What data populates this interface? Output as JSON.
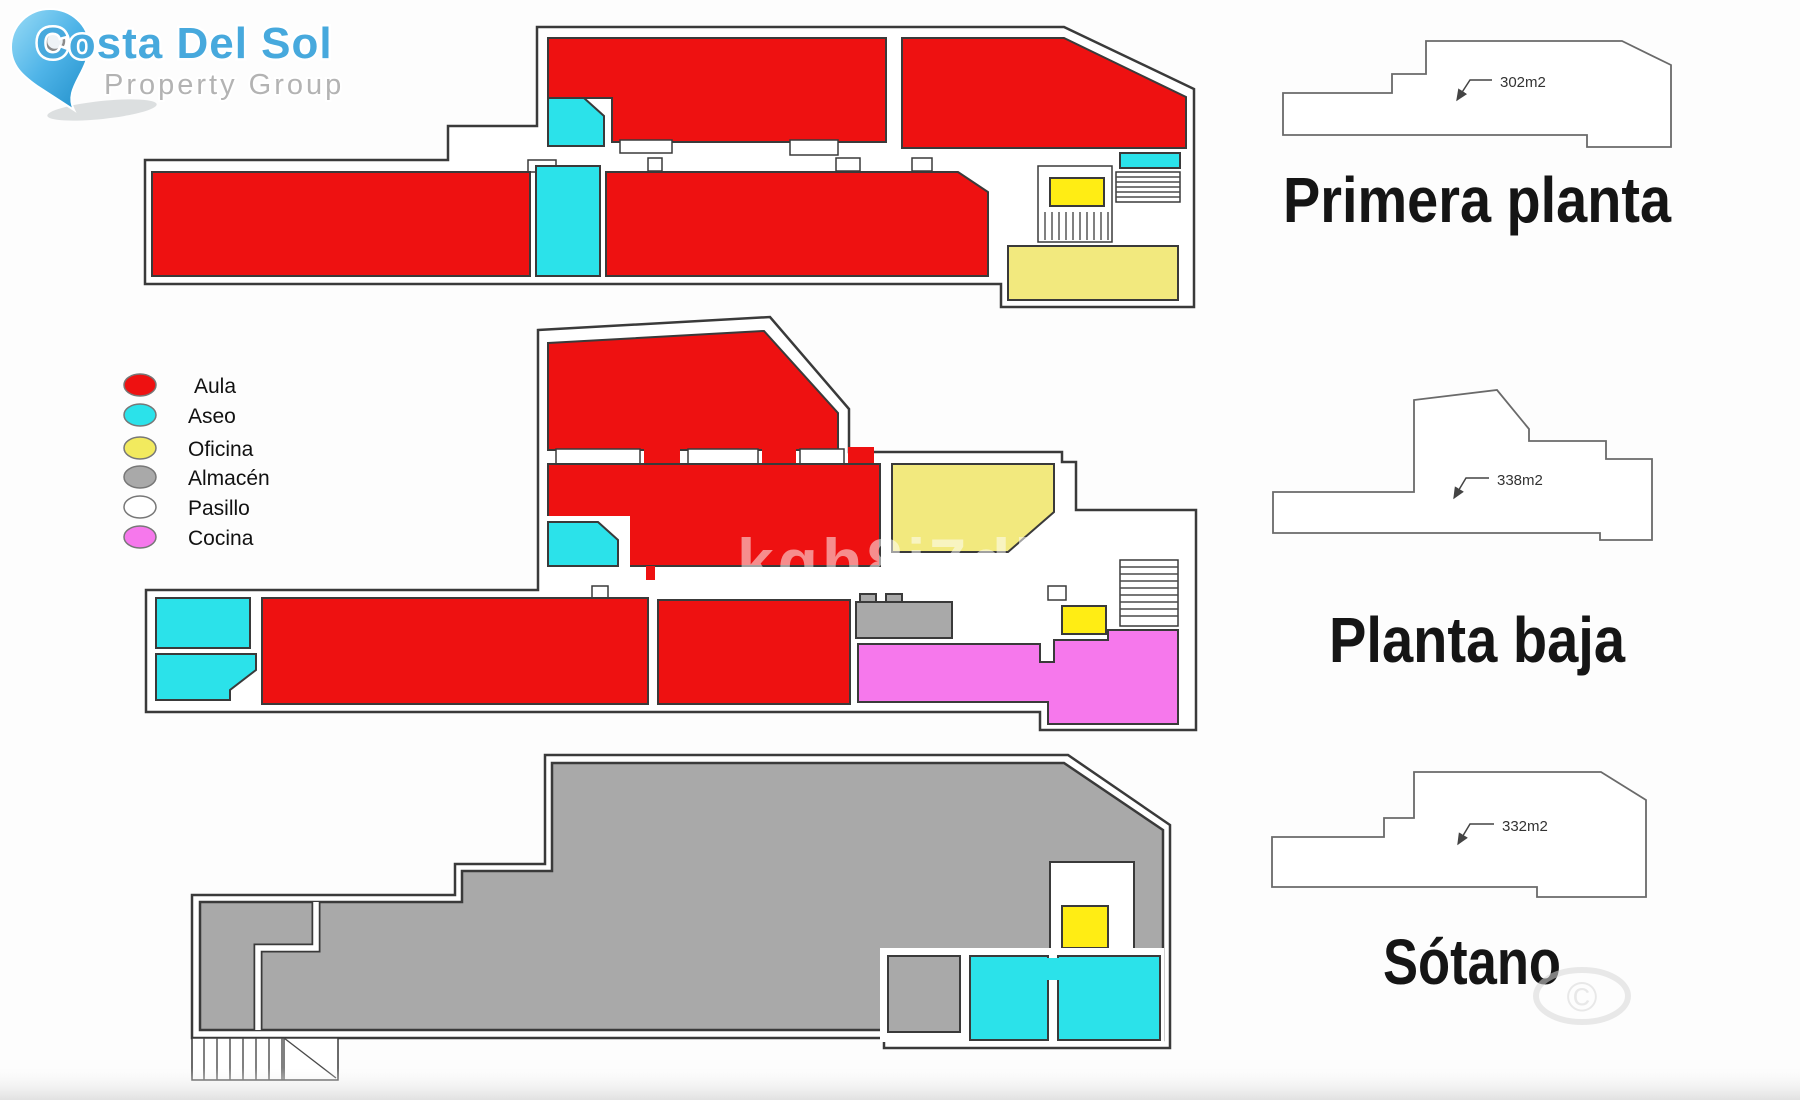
{
  "logo": {
    "title": "Costa Del Sol",
    "subtitle": "Property Group",
    "pin_icon": "map-pin-icon",
    "title_color": "#47A9DD",
    "subtitle_color": "#B3B3B3"
  },
  "legend": {
    "items": [
      {
        "label": "Aula",
        "color": "#EE1111"
      },
      {
        "label": "Aseo",
        "color": "#2BE2EA"
      },
      {
        "label": "Oficina",
        "color": "#F2EA5E"
      },
      {
        "label": "Almacén",
        "color": "#A9A9A9"
      },
      {
        "label": "Pasillo",
        "color": "#FFFFFF"
      },
      {
        "label": "Cocina",
        "color": "#F678EC"
      }
    ]
  },
  "floors": [
    {
      "title": "Primera planta",
      "area_label": "302m2"
    },
    {
      "title": "Planta baja",
      "area_label": "338m2"
    },
    {
      "title": "Sótano",
      "area_label": "332m2"
    }
  ],
  "watermark": {
    "text": "kgh8i7dbh"
  },
  "stamp": {
    "symbol": "©"
  },
  "palette": {
    "aula": "#EE1111",
    "aseo": "#2BE2EA",
    "oficina_bright": "#FFED14",
    "oficina_pale": "#F2E97E",
    "almacen": "#A9A9A9",
    "pasillo": "#FFFFFF",
    "cocina": "#F678EC",
    "wall": "#3A3A3A"
  }
}
